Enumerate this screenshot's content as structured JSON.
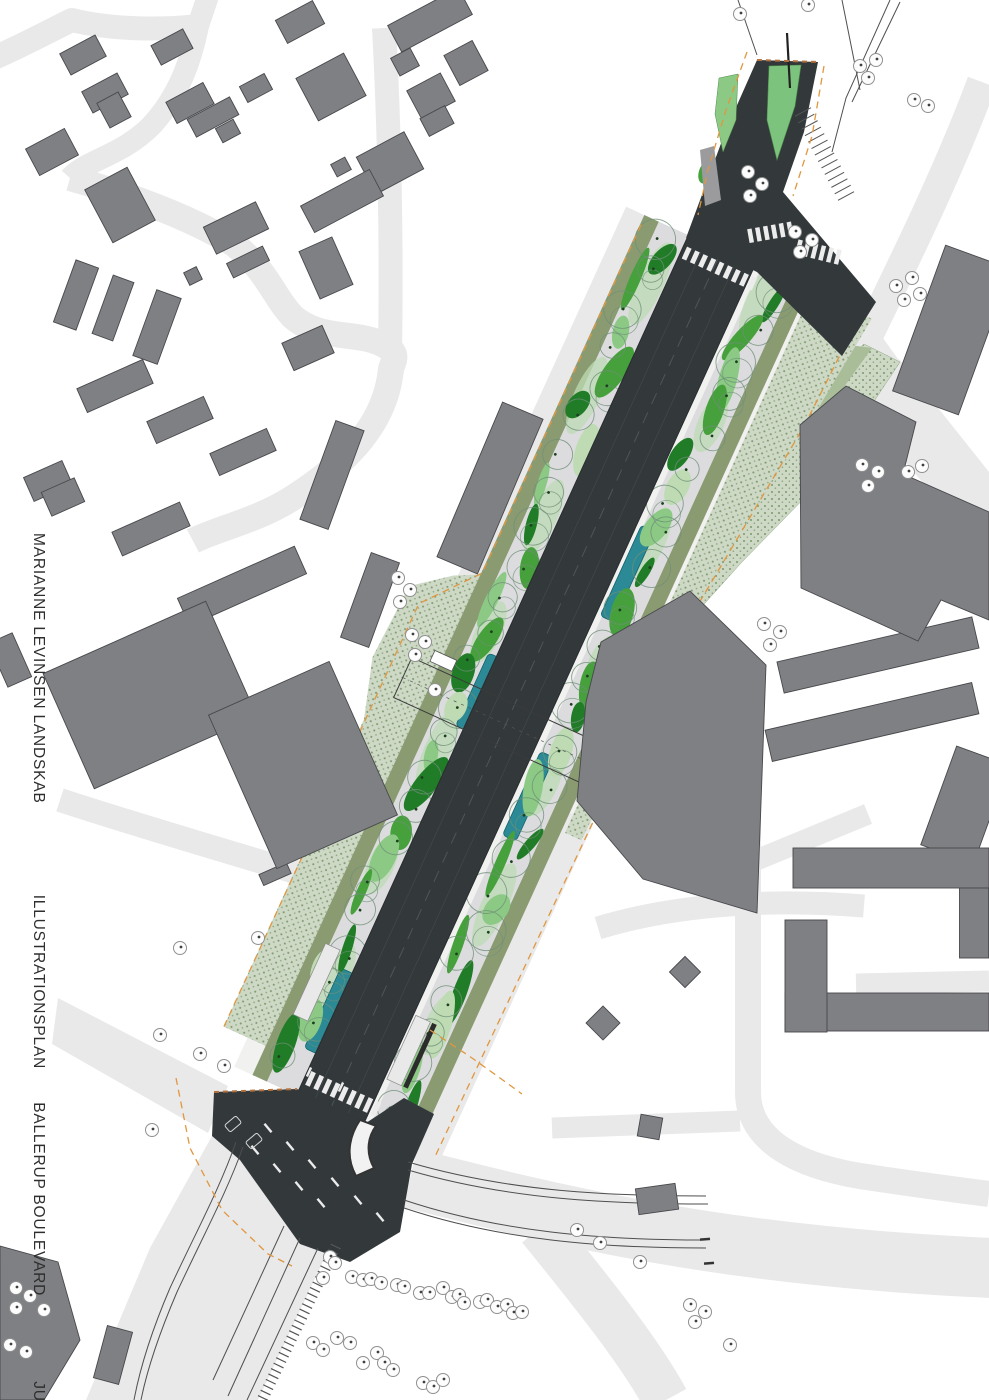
{
  "titleblock": {
    "firm": "MARIANNE LEVINSEN LANDSKAB",
    "drawing_type": "ILLUSTRATIONSPLAN",
    "project": "BALLERUP BOULEVARD",
    "date": "JULI 2017"
  },
  "palette": {
    "background": "#ffffff",
    "street": "#e9e9ea",
    "pavement": "#f1f1f0",
    "sidewalk": "#dcdcde",
    "asphalt": "#33383b",
    "asphalt_edge": "#23272a",
    "building": "#7f8083",
    "building_stroke": "#47484b",
    "sage_bg": "#cdd8c5",
    "sage_dot": "#7e9a70",
    "sage_solid": "#a9bd98",
    "olive": "#8a9b72",
    "green_mid": "#46a03c",
    "green_dark": "#217c28",
    "green_light": "#8cc985",
    "green_pale": "#bedbb4",
    "island_green": "#7cc47e",
    "teal": "#2b8a95",
    "teal_stroke": "#13646e",
    "canopy_ring": "#6e8f77",
    "tree_trunk": "#1d3f20",
    "tree_symbol_stroke": "#8f9090",
    "tree_symbol_dot": "#3f4040",
    "orange_dash": "#e0973f",
    "ochre_dash": "#b5713c",
    "marking_white": "#ececec",
    "line_dark": "#4f4f4f",
    "text_color": "#2e2e2e"
  }
}
